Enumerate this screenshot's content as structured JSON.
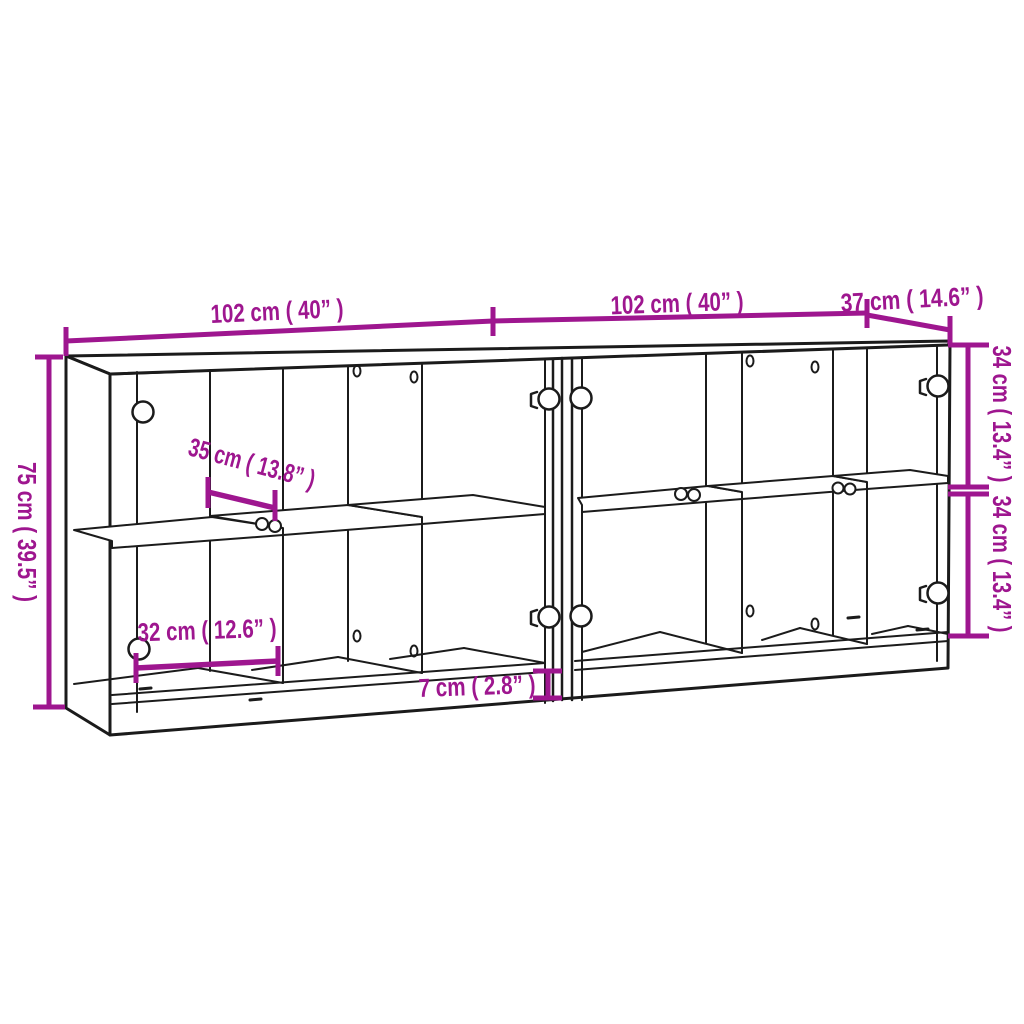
{
  "diagram": {
    "type": "furniture-dimension-drawing",
    "subject": "bookcase-with-glass-doors-two-units",
    "colors": {
      "dimension": "#9e168f",
      "line": "#1b1b1b",
      "background": "#ffffff"
    },
    "dimensions": {
      "width_left_unit": "102 cm ( 40” )",
      "width_right_unit": "102 cm ( 40” )",
      "depth": "37 cm ( 14.6” )",
      "height": "75 cm ( 39.5” )",
      "upper_compartment_height": "34 cm ( 13.4” )",
      "lower_compartment_height": "34 cm ( 13.4” )",
      "shelf_depth": "35 cm ( 13.8” )",
      "compartment_width": "32 cm ( 12.6” )",
      "plinth_height": "7 cm ( 2.8” )"
    }
  }
}
